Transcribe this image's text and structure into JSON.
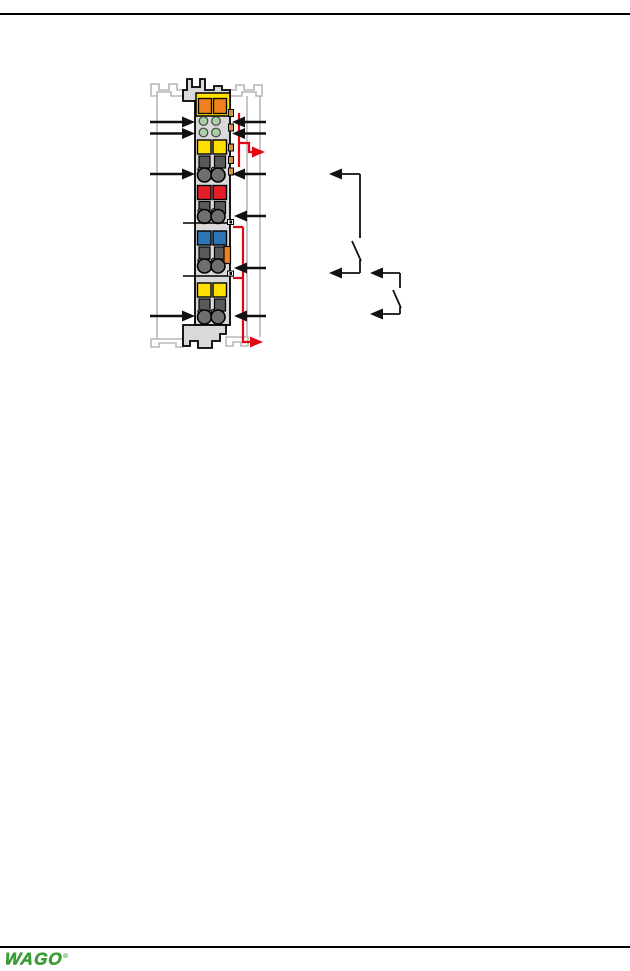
{
  "footer": {
    "logo_text": "WAGO",
    "registered_mark": "®"
  },
  "colors": {
    "rule": "#000000",
    "logo_green": "#3c9b35",
    "rail": "#b8b8b8",
    "body": "#d9d9d9",
    "outline": "#000000",
    "yellow": "#ffe000",
    "orange": "#f07f1e",
    "led_green": "#a9cfa4",
    "red_block": "#e51d25",
    "blue_block": "#2e75b5",
    "dark_clamp": "#5a5a5a",
    "clamp_circle": "#6f6f6f",
    "tan_tab": "#d2944a",
    "wire": "#111111",
    "jumper_red": "#e30613"
  },
  "diagram": {
    "parts": {
      "rail": "din-rail-profile",
      "module": "io-module-front-view",
      "signal_arrows": "signal-connection-arrows",
      "jumpers": "power-jumper-arrows",
      "switches": "external-switch-contacts"
    }
  }
}
